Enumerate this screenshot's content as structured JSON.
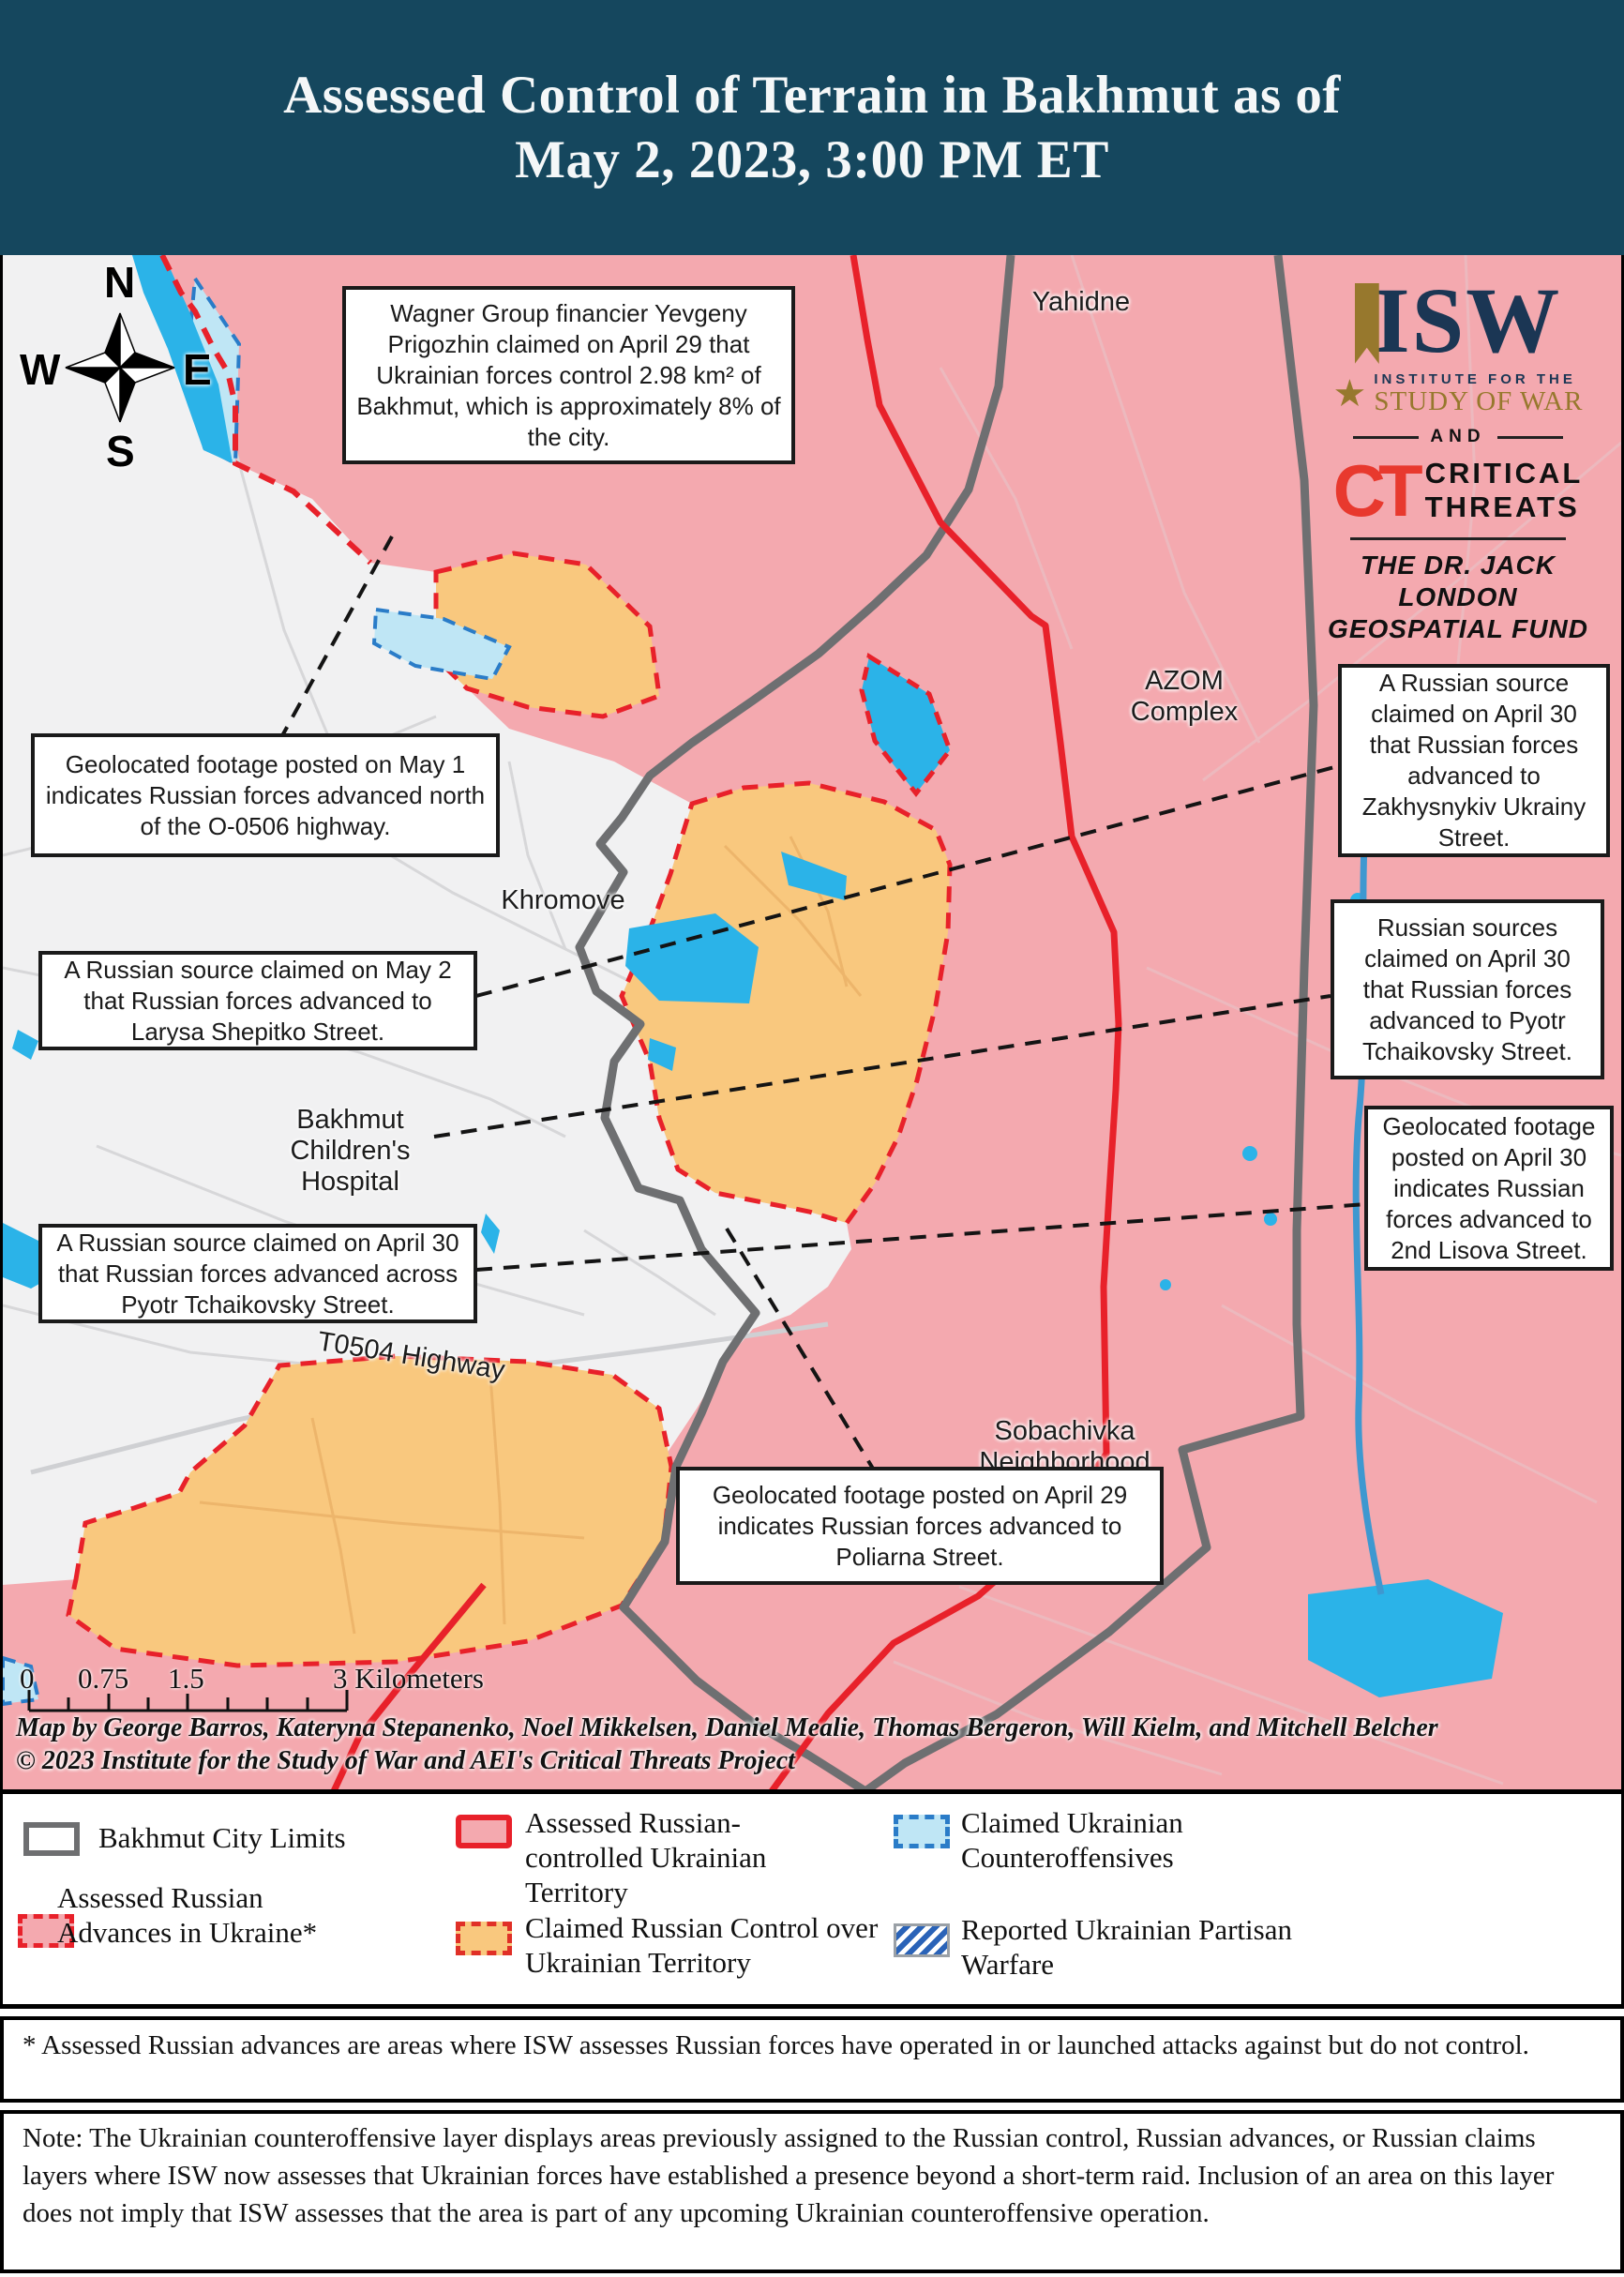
{
  "header": {
    "title_line1": "Assessed Control of Terrain in Bakhmut as of",
    "title_line2": "May 2, 2023, 3:00 PM ET"
  },
  "colors": {
    "header_bg": "#15475e",
    "russian_controlled_pink": "#f4a9af",
    "claimed_russian_orange": "#f9c87e",
    "contested_white": "#f1f1f2",
    "water_blue": "#2bb3e8",
    "counteroffensive_blue": "#bfe6f5",
    "front_line_red": "#e8212a",
    "city_limits_gray": "#6e6f71",
    "isw_navy": "#1b3654",
    "isw_gold": "#97782d",
    "ct_red": "#e8392e"
  },
  "compass": {
    "n": "N",
    "s": "S",
    "e": "E",
    "w": "W"
  },
  "logo": {
    "isw": "ISW",
    "star": "★",
    "institute": "INSTITUTE FOR THE",
    "study": "STUDY OF WAR",
    "and": "AND",
    "ct": "CT",
    "critical": "CRITICAL",
    "threats": "THREATS",
    "fund_line1": "THE DR. JACK LONDON",
    "fund_line2": "GEOSPATIAL FUND"
  },
  "map": {
    "callouts": [
      {
        "name": "wagner-claim",
        "text": "Wagner Group financier Yevgeny Prigozhin claimed on April 29 that Ukrainian forces control 2.98 km² of Bakhmut, which is approximately 8% of the city."
      },
      {
        "name": "may1-advance",
        "text": "Geolocated footage posted on May 1 indicates Russian forces advanced north of the O-0506 highway."
      },
      {
        "name": "larysa-shepitko",
        "text": "A Russian source claimed on May 2 that Russian forces advanced to Larysa Shepitko Street."
      },
      {
        "name": "across-tchaikovsky",
        "text": "A Russian source claimed on April 30 that Russian forces advanced across Pyotr Tchaikovsky Street."
      },
      {
        "name": "zakhysnykiv-ukrainy",
        "text": "A Russian source claimed on April 30 that Russian forces advanced to Zakhysnykiv Ukrainy Street."
      },
      {
        "name": "pyotr-tchaikovsky",
        "text": "Russian sources claimed on April 30 that Russian forces advanced to Pyotr Tchaikovsky Street."
      },
      {
        "name": "2nd-lisova",
        "text": "Geolocated footage posted on April 30 indicates Russian forces advanced to 2nd Lisova Street."
      },
      {
        "name": "poliarna",
        "text": "Geolocated footage posted on April 29 indicates Russian forces advanced to Poliarna Street."
      }
    ],
    "place_labels": [
      {
        "name": "yahidne",
        "line1": "Yahidne",
        "line2": ""
      },
      {
        "name": "azom-complex",
        "line1": "AZOM",
        "line2": "Complex"
      },
      {
        "name": "khromove",
        "line1": "Khromove",
        "line2": ""
      },
      {
        "name": "bakhmut-childrens-hospital",
        "line1": "Bakhmut Children's",
        "line2": "Hospital"
      },
      {
        "name": "t0504-highway",
        "line1": "T0504 Highway",
        "line2": ""
      },
      {
        "name": "sobachivka",
        "line1": "Sobachivka",
        "line2": "Neighborhood"
      }
    ],
    "scale": {
      "labels": [
        "0",
        "0.75",
        "1.5",
        "3 Kilometers"
      ]
    },
    "credits_line1": "Map by George Barros, Kateryna Stepanenko, Noel Mikkelsen, Daniel Mealie, Thomas Bergeron, Will Kielm, and Mitchell Belcher",
    "credits_line2": "© 2023 Institute for the Study of War and AEI's Critical Threats Project"
  },
  "legend": {
    "items": [
      {
        "label": "Bakhmut City Limits"
      },
      {
        "label": "Assessed Russian Advances in Ukraine*"
      },
      {
        "label": "Assessed Russian-controlled Ukrainian Territory"
      },
      {
        "label": "Claimed Russian Control over Ukrainian Territory"
      },
      {
        "label": "Claimed Ukrainian Counteroffensives"
      },
      {
        "label": "Reported Ukrainian Partisan Warfare"
      }
    ]
  },
  "footnote": "* Assessed Russian advances are areas where ISW assesses Russian forces have operated in or launched attacks against but do not control.",
  "note": "Note: The Ukrainian counteroffensive layer displays areas previously assigned to the Russian control, Russian advances, or Russian claims layers where ISW now assesses that Ukrainian forces have established a presence beyond a short-term raid. Inclusion of an area on this layer does not imply that ISW assesses that the area is part of any upcoming Ukrainian counteroffensive operation."
}
